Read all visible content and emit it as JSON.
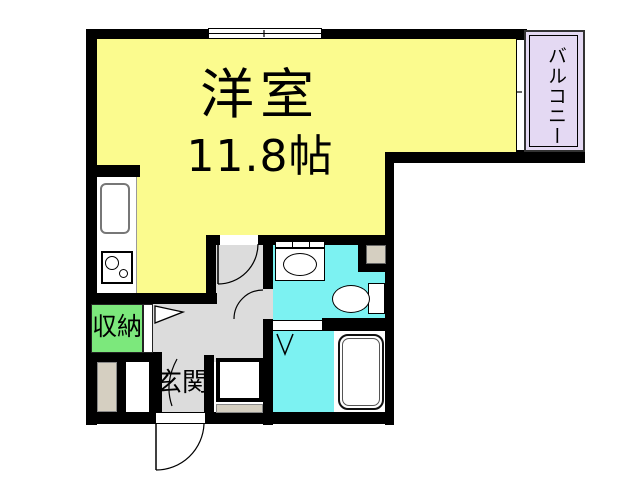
{
  "plan": {
    "type": "apartment-floorplan",
    "rooms": {
      "main_room": {
        "name": "洋室",
        "size": "11.8帖"
      },
      "balcony": {
        "name": "バルコニー"
      },
      "closet": {
        "name": "収納"
      },
      "entrance": {
        "name": "玄関"
      }
    },
    "fixtures": [
      "kitchen-sink",
      "stove-two-burner",
      "washbasin",
      "toilet",
      "bathtub",
      "shoe-cabinet",
      "washer-space"
    ],
    "colors": {
      "room_yellow": "#FBFB8E",
      "balcony_lavender": "#E4D9F3",
      "wet_cyan": "#7CF2F2",
      "closet_green": "#7CE87C",
      "floor_gray": "#DCDCDC",
      "beige": "#D5CFC1",
      "wall_black": "#000000",
      "fixture_white": "#FFFFFF"
    }
  }
}
